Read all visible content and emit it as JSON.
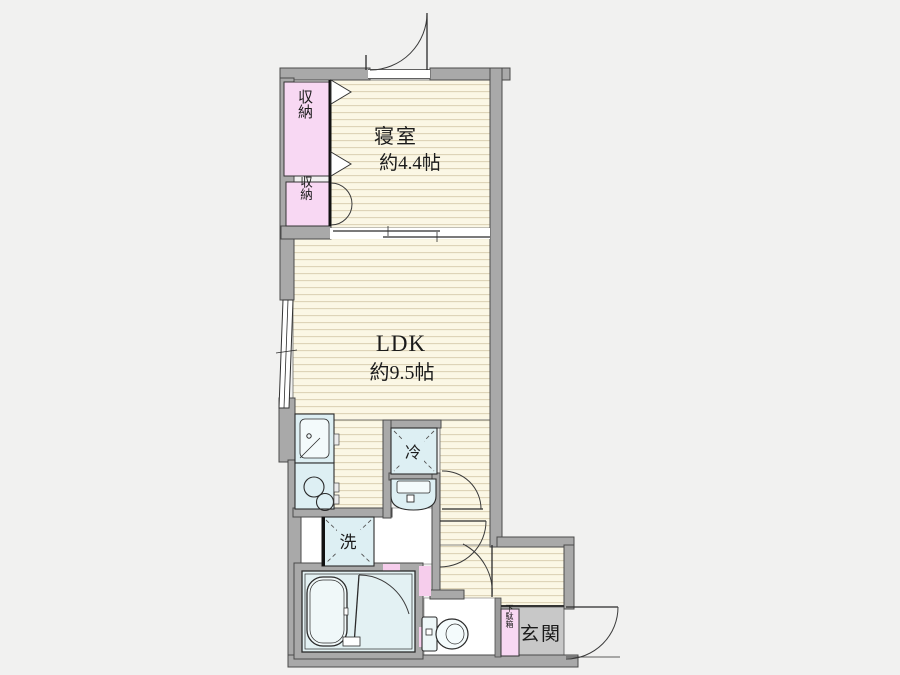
{
  "plan": {
    "type": "floor-plan",
    "rooms": {
      "bedroom": {
        "name": "寝室",
        "size": "約4.4帖"
      },
      "ldk": {
        "name": "LDK",
        "size": "約9.5帖"
      },
      "entrance": {
        "label": "玄関"
      }
    },
    "labels": {
      "closet_upper": "収納",
      "closet_lower": "収納",
      "refrigerator": "冷",
      "washer": "洗",
      "shoe_cabinet": "下駄箱"
    },
    "colors": {
      "background": "#f1f1f0",
      "wall": "#a9a9a9",
      "wall_outline": "#4a4a4a",
      "floor": "#fbf7e5",
      "floor_stripe": "#dcd3b6",
      "fixture_fill": "#ddeff3",
      "closet_pink": "#f8d8f3",
      "accent_pink": "#f6cdec",
      "entrance_floor": "#c8c8c8",
      "line": "#222222"
    }
  }
}
